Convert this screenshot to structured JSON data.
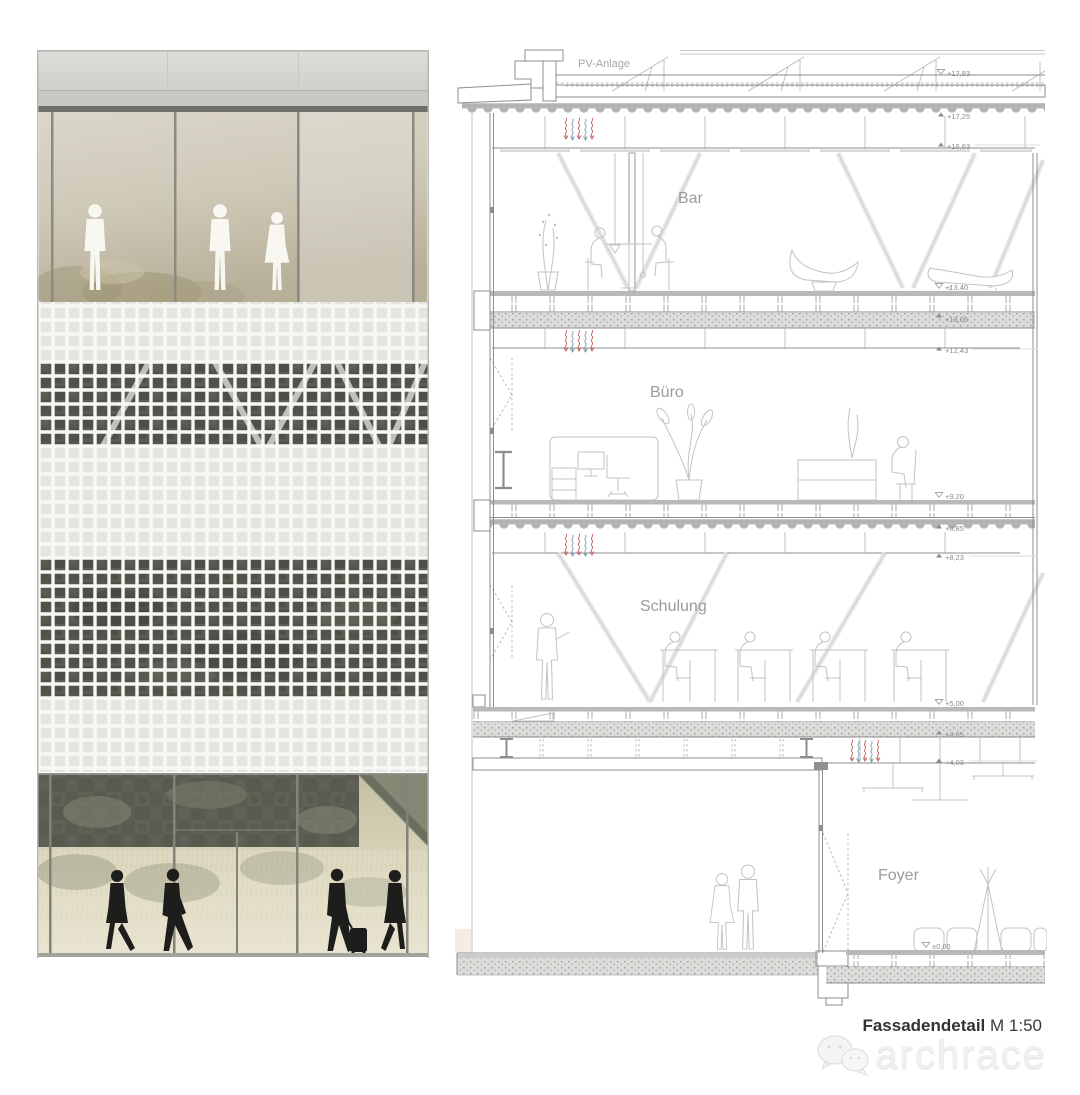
{
  "sheet": {
    "background": "#ffffff"
  },
  "facade_elevation": {
    "figures_upper": 3,
    "figures_lower": 4,
    "colors": {
      "parapet": "#d9dad5",
      "fascia": "#c7c8c3",
      "glass_tint": "#cfc9b8",
      "screen_light": "#e4e5e0",
      "screen_dark": "#54554d",
      "silhouette_upper": "#faf9f4",
      "silhouette_lower": "#1d1d1b"
    }
  },
  "section": {
    "pv_label": "PV-Anlage",
    "floor_labels": {
      "bar": "Bar",
      "buero": "Büro",
      "schulung": "Schulung",
      "foyer": "Foyer"
    },
    "elevations": {
      "e1783": "+17,83",
      "e1725": "+17,25",
      "e1663": "+16,63",
      "e1340": "+13,40",
      "e1306": "+13,06",
      "e1243": "+12,43",
      "e920": "+9,20",
      "e885": "+8,85",
      "e823": "+8,23",
      "e500": "+5,00",
      "e465": "+4,65",
      "e403": "+4,03",
      "e000": "±0,00"
    },
    "accent_colors": {
      "vent_warm": "#c4655e",
      "vent_cool": "#7d9fae"
    }
  },
  "caption": {
    "title": "Fassadendetail",
    "scale": "M 1:50"
  },
  "watermark": {
    "text": "archrace"
  }
}
